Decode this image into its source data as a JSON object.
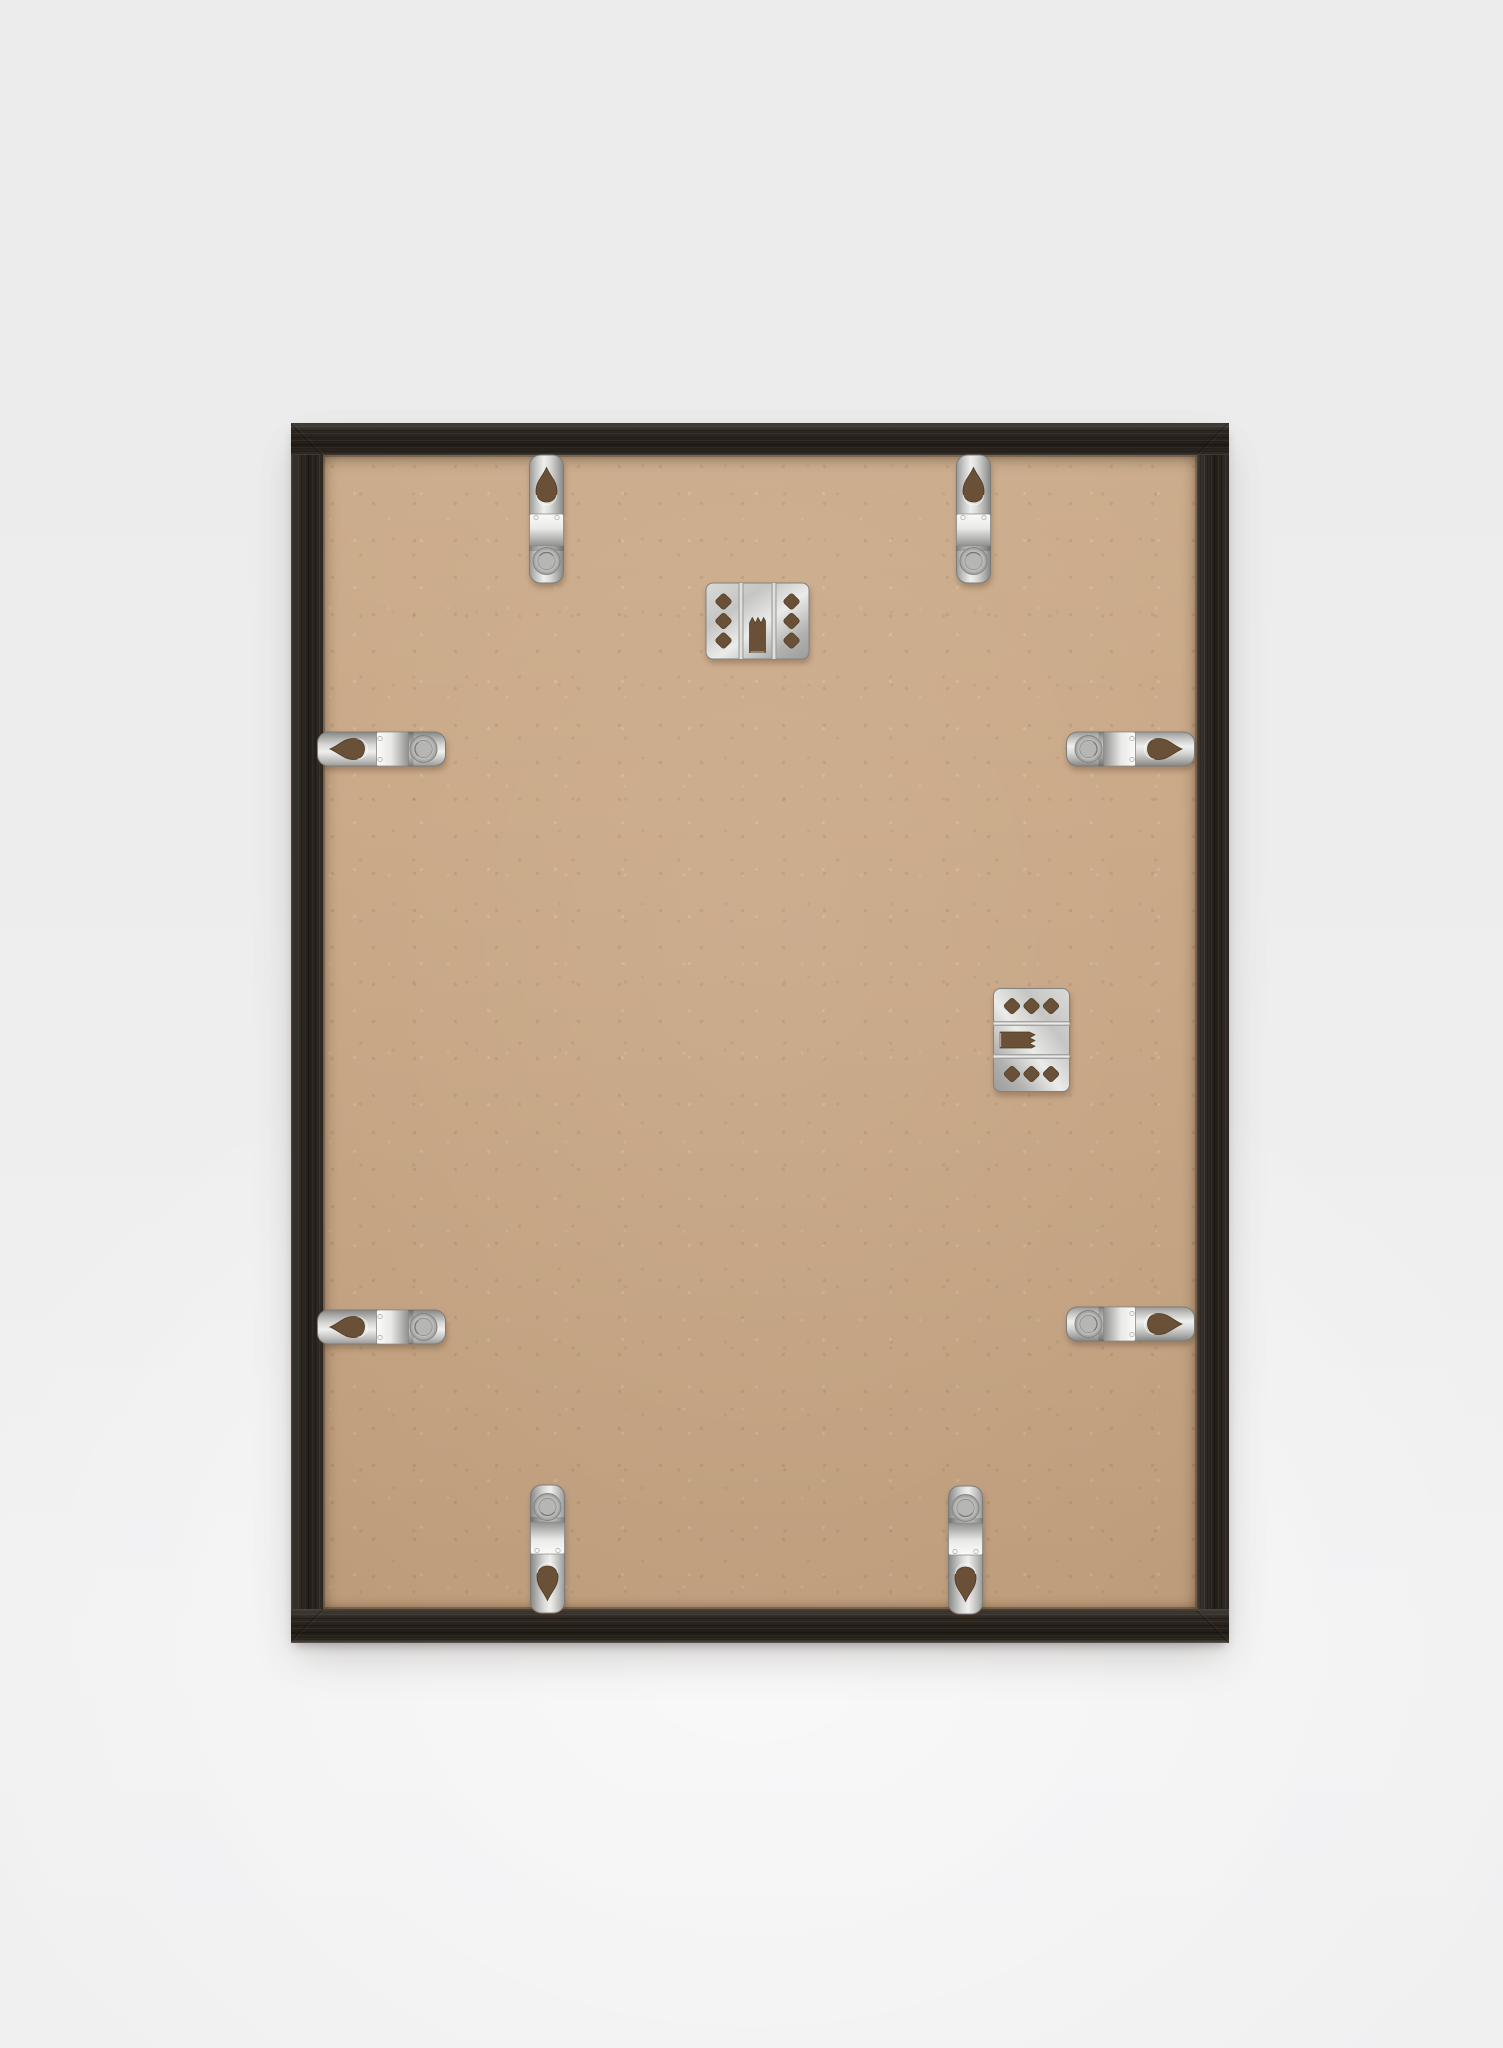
{
  "scene": {
    "description": "Product photograph: rear view of a dark wooden picture frame standing upright against a plain light gray studio backdrop",
    "background": {
      "top_color": "#ececec",
      "bottom_color": "#f1f1f2"
    },
    "frame": {
      "style": "thin black stained wood, visible grain",
      "wood_color": "#27201a",
      "wood_highlight": "#4a423a",
      "left": 291,
      "top": 423,
      "width": 938,
      "height": 1220,
      "border": {
        "top": 32,
        "left": 32,
        "right": 32,
        "bottom": 34
      },
      "backing": {
        "material_color": "#c9a886",
        "look": "kraft / MDF board with speckles"
      }
    },
    "materials": {
      "metal_light": "#f2f2f0",
      "metal_mid": "#c7c7c5",
      "metal_dark": "#8e8e8c",
      "hole_shadow": "#6a5036"
    }
  },
  "hardware": {
    "retainer_clip_count": 8,
    "hanger_plate_count": 2,
    "items": [
      {
        "type": "clip",
        "name": "retainer-clip-top-left",
        "cx": 255,
        "cy": 96,
        "rot": 0
      },
      {
        "type": "clip",
        "name": "retainer-clip-top-right",
        "cx": 682,
        "cy": 96,
        "rot": 0
      },
      {
        "type": "clip",
        "name": "retainer-clip-left-upper",
        "cx": 90,
        "cy": 326,
        "rot": -90
      },
      {
        "type": "clip",
        "name": "retainer-clip-right-upper",
        "cx": 839,
        "cy": 326,
        "rot": 90
      },
      {
        "type": "clip",
        "name": "retainer-clip-left-lower",
        "cx": 90,
        "cy": 904,
        "rot": -90
      },
      {
        "type": "clip",
        "name": "retainer-clip-right-lower",
        "cx": 839,
        "cy": 901,
        "rot": 90
      },
      {
        "type": "clip",
        "name": "retainer-clip-bottom-left",
        "cx": 256,
        "cy": 1126,
        "rot": 180
      },
      {
        "type": "clip",
        "name": "retainer-clip-bottom-right",
        "cx": 674,
        "cy": 1127,
        "rot": 180
      },
      {
        "type": "hanger",
        "name": "sawtooth-hanger-portrait",
        "cx": 466,
        "cy": 198,
        "rot": 0
      },
      {
        "type": "hanger",
        "name": "sawtooth-hanger-landscape",
        "cx": 740,
        "cy": 617,
        "rot": 90
      }
    ]
  }
}
